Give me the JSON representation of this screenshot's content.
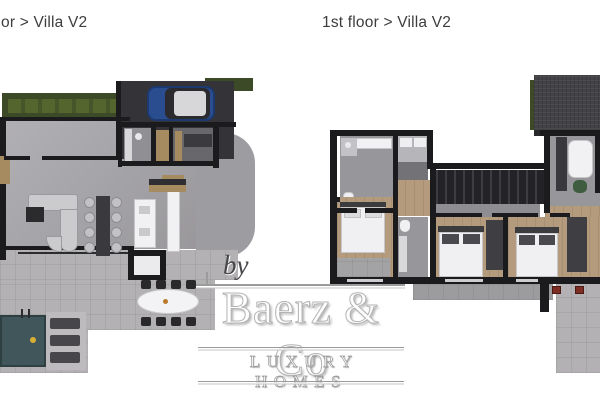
{
  "plans": {
    "left": {
      "label": "or > Villa V2"
    },
    "right": {
      "label": "1st floor > Villa V2"
    }
  },
  "watermark": {
    "by": "by",
    "brand": "Baerz & Co",
    "tagline": "LUXURY HOMES"
  },
  "palette": {
    "wall": "#1b1b1d",
    "title_text": "#3d3d3f",
    "floor_concrete": "#a5a4a8",
    "floor_pavers": "#b3b1b3",
    "floor_wood": "#b59b7e",
    "hedge_dark": "#3d4a27",
    "hedge_light": "#55652e",
    "pool_water": "#41565a",
    "car_blue": "#2a4d8f",
    "roof_dark": "#434347",
    "accent_red": "#7e2c24",
    "accent_green": "#3f5c40",
    "logo_gray": "#9b9b9b"
  }
}
